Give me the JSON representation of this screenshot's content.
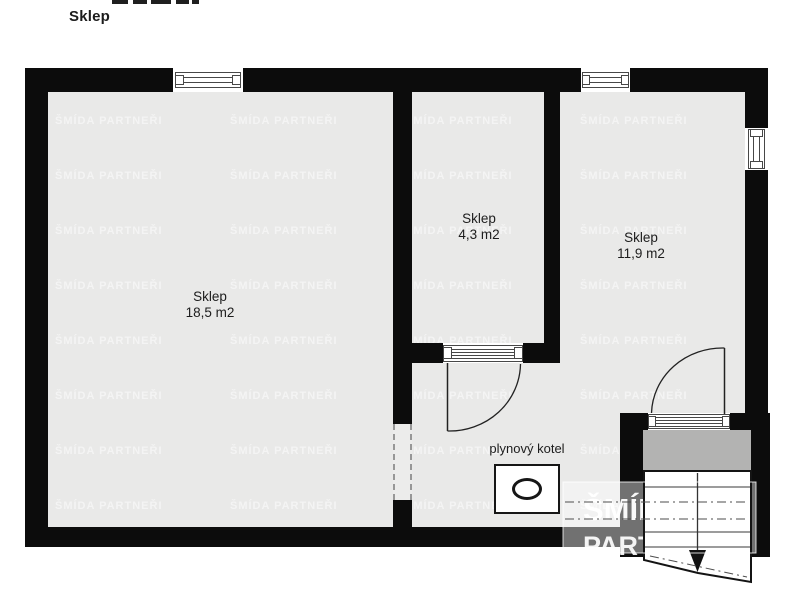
{
  "header": {
    "title": "Sklep"
  },
  "rooms": [
    {
      "name": "Sklep",
      "area": "18,5 m2"
    },
    {
      "name": "Sklep",
      "area": "4,3 m2"
    },
    {
      "name": "Sklep",
      "area": "11,9 m2"
    }
  ],
  "boiler": {
    "label": "plynový kotel"
  },
  "watermark": {
    "line1": "ŠMÍDA",
    "line2": "PARTNEŘI",
    "tile_text": "ŠMÍDA PARTNEŘI"
  },
  "colors": {
    "wall": "#0c0c0c",
    "floor": "#e9e9e8",
    "landing": "#b3b3b2",
    "outside": "#ffffff",
    "watermark_overlay": "rgba(255,255,255,0.42)"
  }
}
